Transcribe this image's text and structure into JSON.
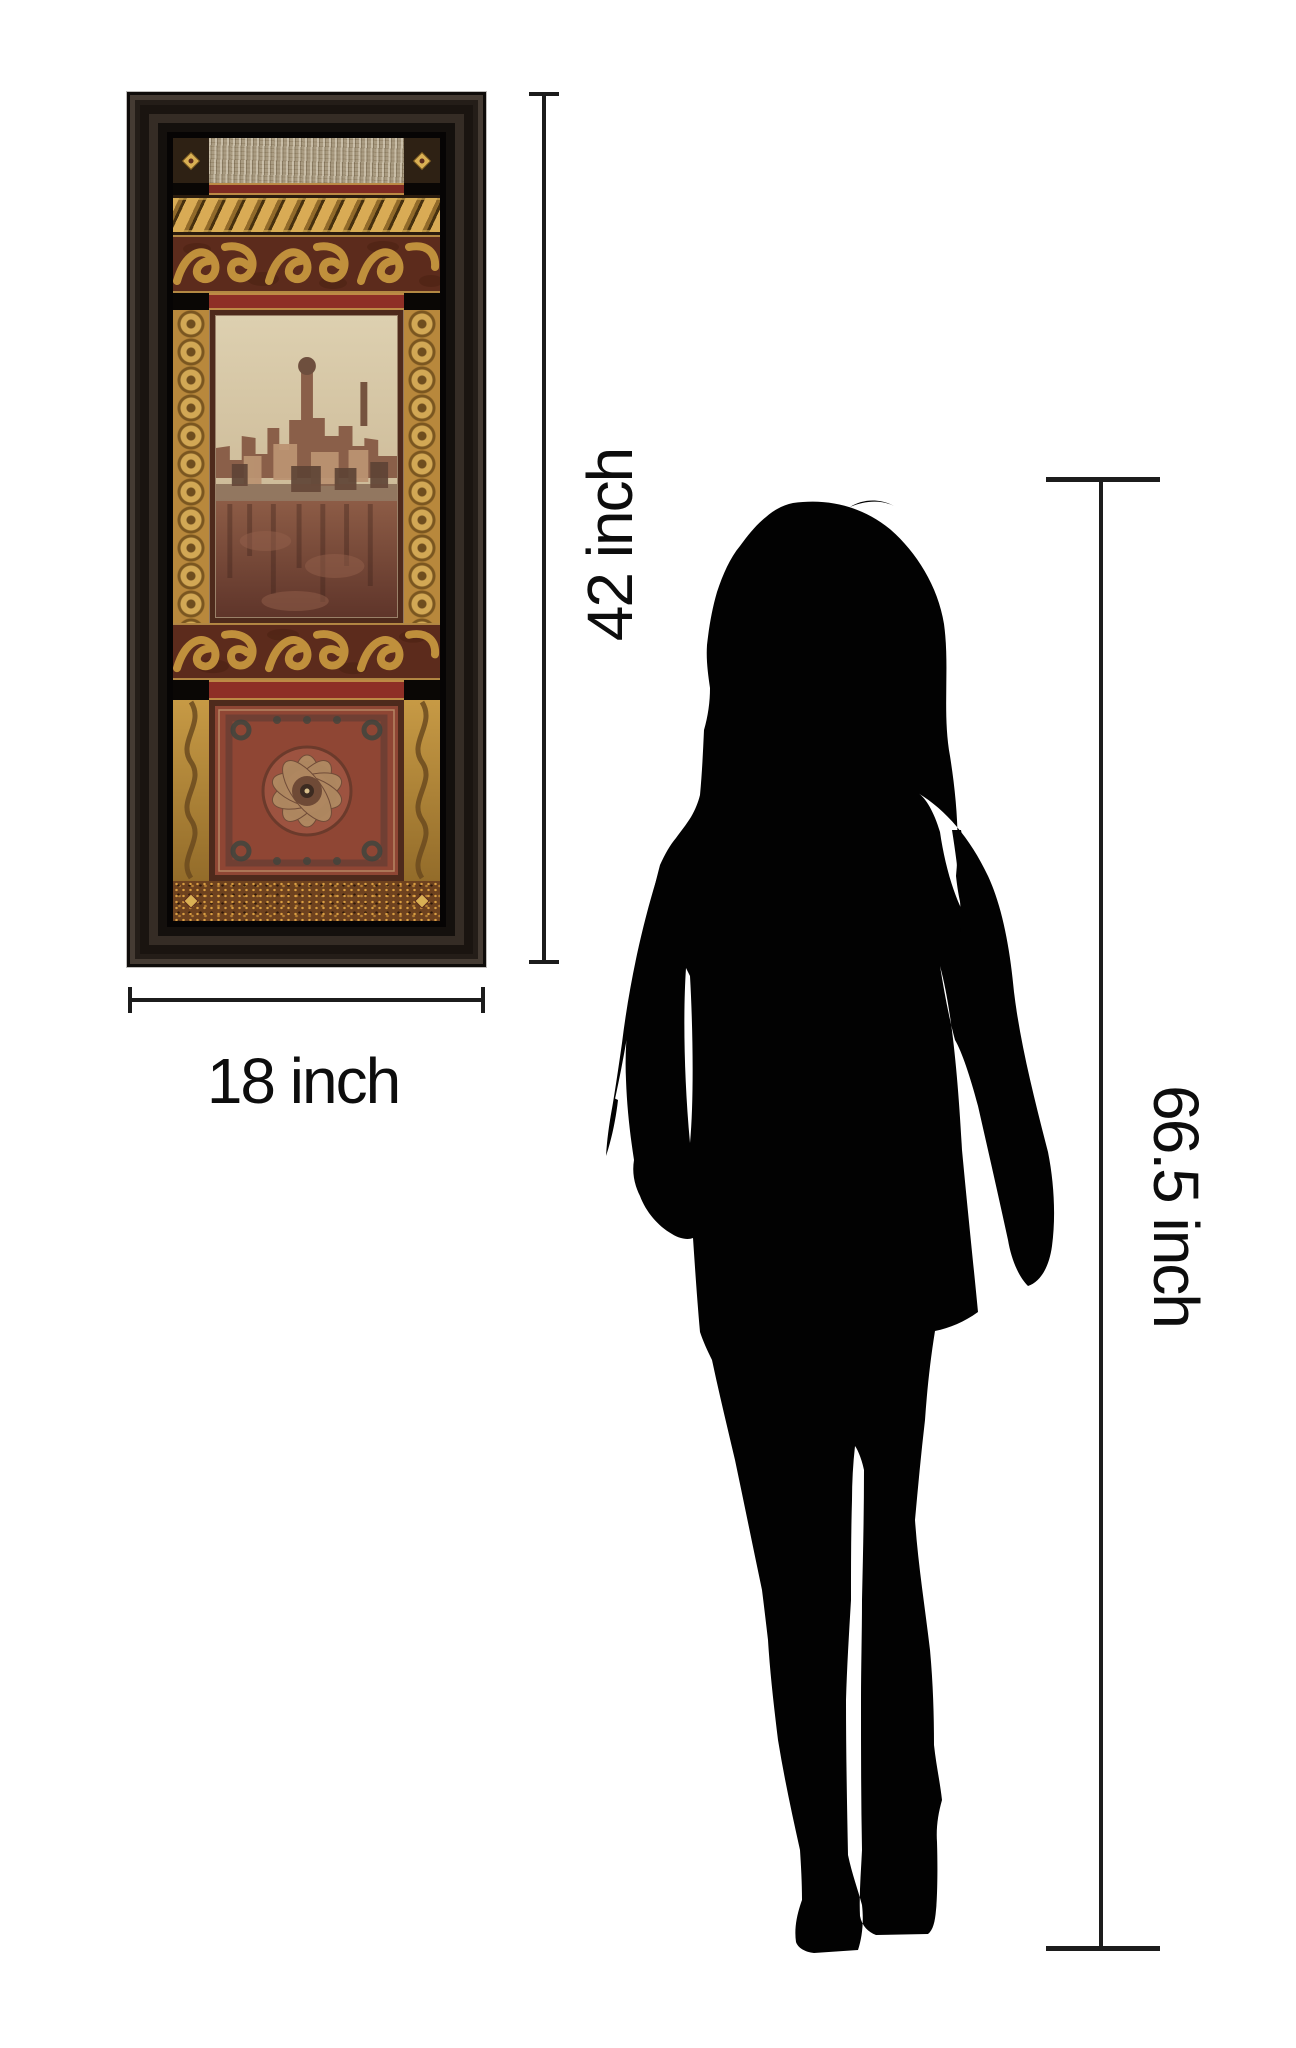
{
  "page": {
    "background": "#ffffff"
  },
  "labels": {
    "artwork_height": "42 inch",
    "artwork_width": "18 inch",
    "person_height": "66.5 inch"
  },
  "measurements": {
    "unit": "inch",
    "artwork_height": 42,
    "artwork_width": 18,
    "person_height": 66.5
  },
  "artwork": {
    "frame_color": "#272019",
    "gold": "#c49244",
    "maroon": "#5c2b1c",
    "crimson": "#8e2f26",
    "silver_band": "#a99b81",
    "sky": "#d2c2a2",
    "rug": "#8f4634"
  },
  "person": {
    "color": "#020202"
  },
  "dimension_lines": {
    "color": "#1c1c1c"
  }
}
